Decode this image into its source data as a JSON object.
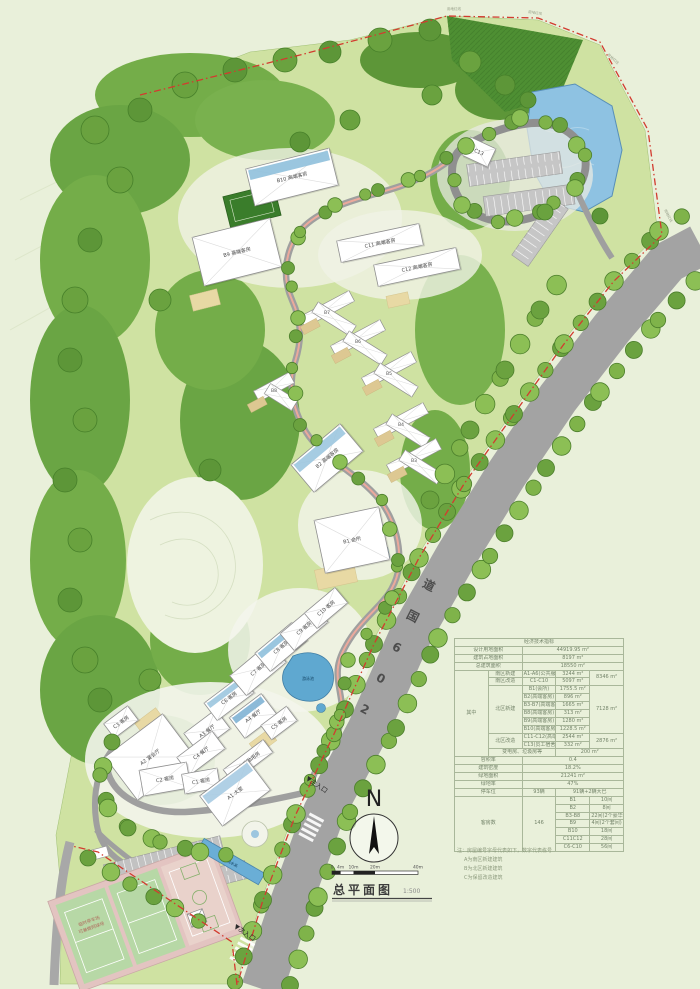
{
  "page_title": "总平面图",
  "scale_label": "1:500",
  "north_label": "N",
  "road_label": "206国道",
  "boundary_label": "用地红线",
  "pool_label": "游泳池",
  "water_feature_label": "景观水系",
  "court_note": [
    "临时停车场",
    "可兼做网球场"
  ],
  "entrances": {
    "main": "▼主入口",
    "secondary": "▼次入口"
  },
  "scale_bar": {
    "ticks": [
      "0",
      "4m",
      "10m",
      "20m",
      "40m"
    ]
  },
  "buildings": {
    "A1": "A1 大堂",
    "A2": "A2 宴会厅",
    "A3": "A3 餐厅",
    "A4": "A4 餐厅",
    "A6": "A6 后勤用房",
    "C1": "C1 客房",
    "C2": "C2 客房",
    "C3": "C3 客房",
    "C4": "C4 餐厅",
    "C5": "C5 客房",
    "C6": "C6 客房",
    "C7": "C7 客房",
    "C8": "C8 客房",
    "C9": "C9 客房",
    "C10": "C10 客房",
    "B1": "B1 会所",
    "B2": "B2 高端客房",
    "B3": "B3",
    "B4": "B4",
    "B5": "B5",
    "B6": "B6",
    "B7": "B7",
    "B8": "B8",
    "B9": "B9 高端客房",
    "B10": "B10 高端客房",
    "C11": "C11 高端客房",
    "C12": "C12 高端客房",
    "C13": "C13"
  },
  "table": {
    "rows": [
      [
        {
          "t": "经济技术指标",
          "cs": 5
        }
      ],
      [
        {
          "t": "设计用地面积",
          "cs": 2
        },
        {
          "t": "44919.95 m²",
          "cs": 3
        }
      ],
      [
        {
          "t": "建筑占地面积",
          "cs": 2
        },
        {
          "t": "8197 m²",
          "cs": 3
        }
      ],
      [
        {
          "t": "总建筑面积",
          "cs": 2
        },
        {
          "t": "18550 m²",
          "cs": 3
        }
      ],
      [
        {
          "t": "其中",
          "rs": 11
        },
        {
          "t": "南区新建"
        },
        {
          "t": "A1-A6(公共服务)"
        },
        {
          "t": "3244 m²"
        },
        {
          "t": "8346 m²",
          "rs": 2
        }
      ],
      [
        {
          "t": "南区改造"
        },
        {
          "t": "C1-C10"
        },
        {
          "t": "5097 m²"
        }
      ],
      [
        {
          "t": "北区新建",
          "rs": 6
        },
        {
          "t": "B1(会所)"
        },
        {
          "t": "1755.5 m²"
        },
        {
          "t": "7128 m²",
          "rs": 6
        }
      ],
      [
        {
          "t": "B2(高端客房)"
        },
        {
          "t": "896 m²"
        }
      ],
      [
        {
          "t": "B3-B7(高端客房)"
        },
        {
          "t": "1665 m²"
        }
      ],
      [
        {
          "t": "B8(高端客房)"
        },
        {
          "t": "313 m²"
        }
      ],
      [
        {
          "t": "B9(高端客房)"
        },
        {
          "t": "1280 m²"
        }
      ],
      [
        {
          "t": "B10(高端客房)"
        },
        {
          "t": "1228.5 m²"
        }
      ],
      [
        {
          "t": "北区改造",
          "rs": 2
        },
        {
          "t": "C11-C12(高端客房)"
        },
        {
          "t": "2544 m²"
        },
        {
          "t": "2876 m²",
          "rs": 2
        }
      ],
      [
        {
          "t": "C13(员工宿舍)"
        },
        {
          "t": "332 m²"
        }
      ],
      [
        {
          "t": "变电房、垃圾房等",
          "cs": 2
        },
        {
          "t": "200 m²",
          "cs": 2
        }
      ],
      [
        {
          "t": "容积率",
          "cs": 2
        },
        {
          "t": "0.4",
          "cs": 3
        }
      ],
      [
        {
          "t": "建筑密度",
          "cs": 2
        },
        {
          "t": "18.2%",
          "cs": 3
        }
      ],
      [
        {
          "t": "绿地面积",
          "cs": 2
        },
        {
          "t": "21241 m²",
          "cs": 3
        }
      ],
      [
        {
          "t": "绿地率",
          "cs": 2
        },
        {
          "t": "47%",
          "cs": 3
        }
      ],
      [
        {
          "t": "停车位",
          "cs": 2
        },
        {
          "t": "93辆"
        },
        {
          "t": "91辆+2辆大巴",
          "cs": 2
        }
      ],
      [
        {
          "t": "客房数",
          "cs": 2,
          "rs": 7
        },
        {
          "t": "146",
          "rs": 7
        },
        {
          "t": "B1"
        },
        {
          "t": "10间"
        }
      ],
      [
        {
          "t": "B2"
        },
        {
          "t": "8间"
        }
      ],
      [
        {
          "t": "B3-B8"
        },
        {
          "t": "22间(2个豪华套间)"
        }
      ],
      [
        {
          "t": "B9"
        },
        {
          "t": "4间(2个套间)"
        }
      ],
      [
        {
          "t": "B10"
        },
        {
          "t": "18间"
        }
      ],
      [
        {
          "t": "C11C12"
        },
        {
          "t": "28间"
        }
      ],
      [
        {
          "t": "C6-C10"
        },
        {
          "t": "56间"
        }
      ]
    ]
  },
  "notes": [
    "注：房屋编号字母代表如下，数字代表栋号",
    "A为南区新建建筑",
    "B为北区新建建筑",
    "C为保留改造建筑"
  ],
  "colors": {
    "background": "#e9f0da",
    "site_green": "#cfe2a2",
    "forest": "#74ad49",
    "dense_forest": "#4e8f33",
    "road": "#a3a3a3",
    "water": "#8ec2e2",
    "boundary_red": "#d23b2f",
    "building": "#ffffff",
    "roof_glass": "#9cc6df",
    "terrace_tan": "#e8d9a4"
  }
}
